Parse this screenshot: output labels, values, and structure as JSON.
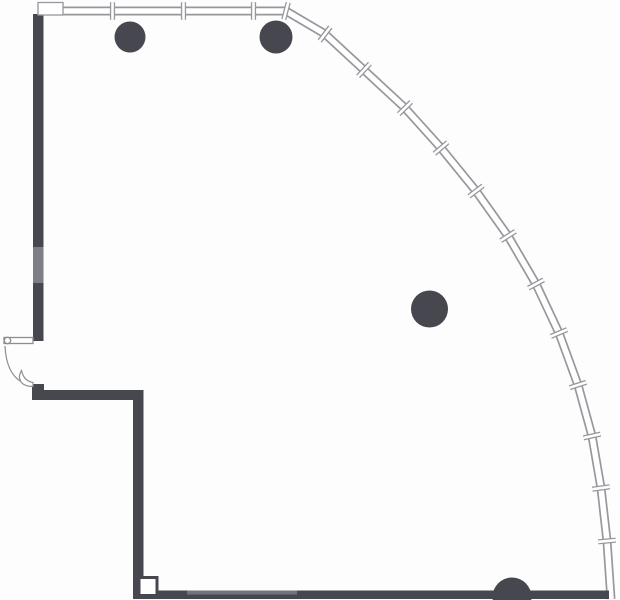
{
  "drawing": {
    "kind": "architectural-floor-plan",
    "canvas": {
      "width": 620,
      "height": 600,
      "background": "#fdfdfd"
    }
  },
  "colors": {
    "wall_dark": "#47474f",
    "wall_line": "#97979d",
    "wall_inner": "#ffffff",
    "wall_gray_segment": "#7e7e86",
    "band_light": "#73737b",
    "door_line": "#8d8d93",
    "column_fill": "#47474f"
  },
  "chart_data": {
    "type": "table",
    "title": "",
    "note": "floor plan geometry (pixel coordinates)",
    "perimeter_window_wall": {
      "points": [
        [
          62,
          11
        ],
        [
          286,
          11
        ],
        [
          325,
          34
        ],
        [
          364,
          70
        ],
        [
          405,
          108
        ],
        [
          441,
          148
        ],
        [
          476,
          191
        ],
        [
          508,
          236
        ],
        [
          536,
          284
        ],
        [
          559,
          333
        ],
        [
          578,
          385
        ],
        [
          592,
          436
        ],
        [
          601,
          488
        ],
        [
          607,
          541
        ],
        [
          611,
          599
        ]
      ],
      "outer_width": 9,
      "inner_width": 5.6
    },
    "mullion_ticks": [
      [
        112.5,
        2.25,
        112.5,
        19.75
      ],
      [
        183.5,
        2.25,
        183.5,
        19.75
      ],
      [
        253.5,
        2.25,
        253.5,
        19.75
      ],
      [
        283.8,
        19.5,
        288.2,
        2.5
      ],
      [
        319.7,
        41.0,
        330.3,
        27.0
      ],
      [
        358.1,
        76.4,
        369.9,
        63.6
      ],
      [
        398.8,
        114.1,
        411.2,
        101.9
      ],
      [
        434.4,
        153.7,
        447.7,
        142.3
      ],
      [
        469.0,
        196.3,
        483.0,
        185.7
      ],
      [
        500.7,
        240.7,
        515.4,
        231.3
      ],
      [
        528.3,
        288.1,
        543.7,
        279.9
      ],
      [
        550.9,
        336.4,
        567.1,
        329.6
      ],
      [
        569.7,
        387.7,
        586.3,
        382.3
      ],
      [
        583.5,
        437.9,
        600.5,
        434.1
      ],
      [
        592.3,
        489.2,
        609.7,
        486.8
      ],
      [
        598.3,
        541.8,
        615.7,
        540.2
      ]
    ],
    "tick_outer_width": 5.2,
    "tick_inner_width": 2.6,
    "solid_rects": [
      {
        "name": "left-wall",
        "x": 33,
        "y": 14,
        "w": 10.5,
        "h": 327,
        "color": "wall_dark"
      },
      {
        "name": "left-wall-gray-segment",
        "x": 33,
        "y": 247,
        "w": 10.5,
        "h": 36,
        "color": "wall_gray_segment"
      },
      {
        "name": "lower-left-wall-stub",
        "x": 32,
        "y": 384,
        "w": 12,
        "h": 16,
        "color": "wall_dark"
      },
      {
        "name": "lower-horizontal-wall",
        "x": 32,
        "y": 390,
        "w": 111,
        "h": 10,
        "color": "wall_dark"
      },
      {
        "name": "lower-vertical-wall",
        "x": 133,
        "y": 390,
        "w": 10.5,
        "h": 202,
        "color": "wall_dark"
      },
      {
        "name": "bottom-wall",
        "x": 133,
        "y": 590.5,
        "w": 476,
        "h": 8.5,
        "color": "wall_dark"
      },
      {
        "name": "bottom-wall-light-strip",
        "x": 187,
        "y": 590.5,
        "w": 110,
        "h": 4,
        "color": "band_light"
      },
      {
        "name": "top-left-wall-cap-bar",
        "x": 40.5,
        "y": 3.2,
        "w": 18,
        "h": 4.2,
        "color": "wall_dark"
      }
    ],
    "outline_rects": [
      {
        "name": "top-left-frame-box",
        "x": 38,
        "y": 2.5,
        "w": 25,
        "h": 12.5,
        "stroke": "wall_line",
        "sw": 1.3,
        "fill": "#ffffff"
      },
      {
        "name": "bottom-door-frame-box",
        "x": 139,
        "y": 577.5,
        "w": 18,
        "h": 18,
        "stroke": "wall_dark",
        "sw": 3,
        "fill": "#ffffff"
      }
    ],
    "columns": [
      {
        "cx": 130,
        "cy": 37,
        "r": 15.5
      },
      {
        "cx": 276,
        "cy": 37,
        "r": 16.5
      },
      {
        "cx": 429.5,
        "cy": 309,
        "r": 18.5
      },
      {
        "cx": 512,
        "cy": 597,
        "r": 19.5
      }
    ],
    "door": {
      "leaf": {
        "x": 4,
        "y": 337.5,
        "w": 29,
        "h": 6
      },
      "hinge": {
        "cx": 7.5,
        "cy": 340.5,
        "r": 3.2
      },
      "swing_path": "M 5 346 Q 6.5 377 26 384",
      "lower_leaf_path": "M 33 386.5 C 21 386.5 16.5 379 21.5 370.5 C 23 377.5 27 381.5 33 382.5 Z"
    }
  }
}
